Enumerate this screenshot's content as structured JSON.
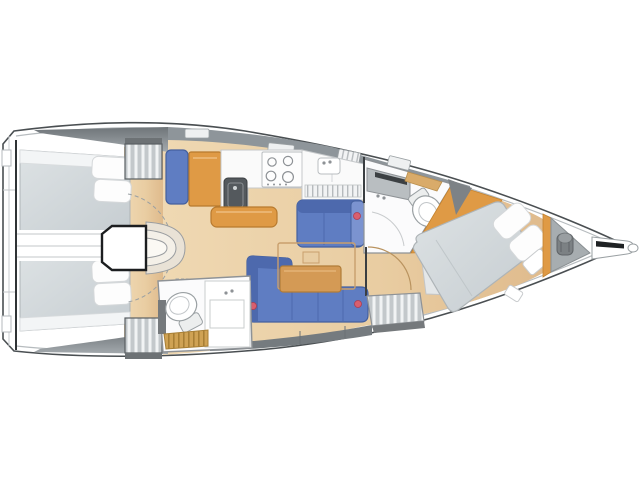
{
  "palette": {
    "background": "#ffffff",
    "hull_line": "#4a4f52",
    "inner_line": "#b6bbbe",
    "deck_gray": "#8e959a",
    "deck_gray_dark": "#757b7f",
    "light_gray": "#c9ced1",
    "floor_light": "#efd8b2",
    "floor_dark": "#dfba8c",
    "wood_orange": "#df9a45",
    "wood_orange_dark": "#b87a2e",
    "wood_table": "#d49a55",
    "gold": "#cfa254",
    "gold_dark": "#a87f35",
    "upholstery_blue": "#5f7dc2",
    "upholstery_blue_dark": "#44609e",
    "upholstery_blue_mid": "#4d69ad",
    "mattress_gray": "#d2d7da",
    "mattress_edge": "#aeb4b7",
    "room_white": "#fbfbfc",
    "room_line": "#8e9296",
    "accent_red": "#d95f6e",
    "dark_fixture": "#54595d",
    "step_cream": "#e9e2d6"
  },
  "diagram": {
    "type": "sailboat-interior-layout-plan",
    "orientation": "bow-right-stern-left",
    "zones": [
      {
        "id": "stern-platform",
        "items": [
          "transom",
          "swim-platform-steps"
        ]
      },
      {
        "id": "aft-cabin-upper",
        "items": [
          "double-berth",
          "pillows",
          "hanging-locker"
        ]
      },
      {
        "id": "aft-cabin-lower",
        "items": [
          "double-berth",
          "pillows",
          "hanging-locker"
        ]
      },
      {
        "id": "companionway",
        "items": [
          "entry-steps",
          "engine-box",
          "swing-arc"
        ]
      },
      {
        "id": "nav-galley",
        "items": [
          "nav-seat",
          "chart-table",
          "sink",
          "stove-burners",
          "counter",
          "fridge",
          "island-cabinet",
          "vent-grille"
        ]
      },
      {
        "id": "salon",
        "items": [
          "straight-settee",
          "l-shaped-settee",
          "folding-table",
          "wood-tabletop",
          "accent-cushion-buttons"
        ]
      },
      {
        "id": "aft-head",
        "items": [
          "toilet",
          "vanity-counter",
          "teak-grating"
        ]
      },
      {
        "id": "forward-head",
        "items": [
          "toilet",
          "vanity-cabinet",
          "shower-floor",
          "wood-shelf"
        ]
      },
      {
        "id": "forward-cabin",
        "items": [
          "island-double-berth",
          "pillows",
          "bedside-units",
          "slatted-locker",
          "door-swing-arc",
          "sole-wedges"
        ]
      },
      {
        "id": "bow",
        "items": [
          "anchor-locker",
          "windlass-drum",
          "bowsprit",
          "deck-hatches"
        ]
      }
    ]
  }
}
